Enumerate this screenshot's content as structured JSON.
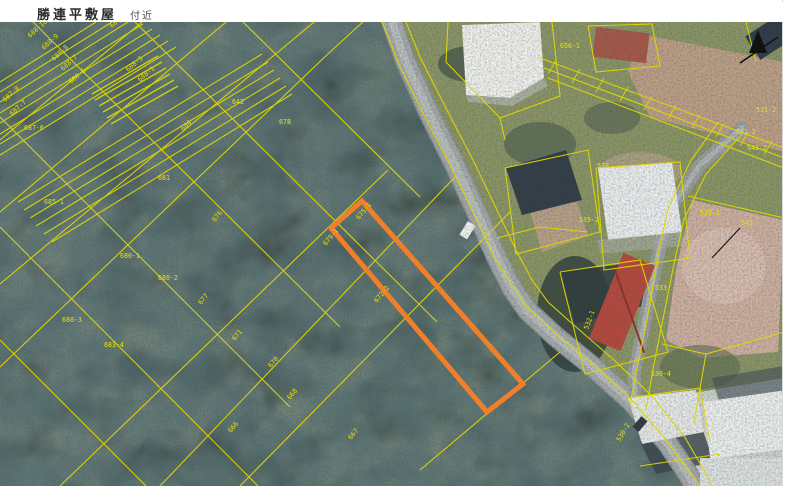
{
  "header": {
    "title": "勝連平敷屋",
    "suffix": "付近"
  },
  "map": {
    "type": "aerial-photo-with-cadastral-overlay",
    "colors": {
      "parcel_line": "#ddd800",
      "parcel_label": "#e9e300",
      "highlight": "#f07f2a",
      "road": "#a6aaa9"
    },
    "highlight_parcel": {
      "label": "675-1"
    },
    "north_arrow": "north-arrow",
    "parcel_labels": [
      {
        "text": "688-10",
        "x": 30,
        "y": 16,
        "r": -42
      },
      {
        "text": "688-9",
        "x": 44,
        "y": 28,
        "r": -42
      },
      {
        "text": "688-8",
        "x": 54,
        "y": 39,
        "r": -42
      },
      {
        "text": "688-7",
        "x": 63,
        "y": 49,
        "r": -42
      },
      {
        "text": "688-6",
        "x": 71,
        "y": 62,
        "r": -40
      },
      {
        "text": "687-8",
        "x": 5,
        "y": 80,
        "r": -42
      },
      {
        "text": "687-7",
        "x": 12,
        "y": 94,
        "r": -42
      },
      {
        "text": "687-6",
        "x": 24,
        "y": 108,
        "r": 0
      },
      {
        "text": "688-3",
        "x": 128,
        "y": 50,
        "r": -40
      },
      {
        "text": "688-1",
        "x": 140,
        "y": 60,
        "r": -40
      },
      {
        "text": "683",
        "x": 112,
        "y": 6,
        "r": -42
      },
      {
        "text": "642",
        "x": 232,
        "y": 82,
        "r": 0
      },
      {
        "text": "678",
        "x": 279,
        "y": 102,
        "r": 0
      },
      {
        "text": "684",
        "x": 183,
        "y": 109,
        "r": -42
      },
      {
        "text": "681",
        "x": 158,
        "y": 158,
        "r": 0
      },
      {
        "text": "676",
        "x": 215,
        "y": 200,
        "r": -50
      },
      {
        "text": "685-1",
        "x": 44,
        "y": 182,
        "r": 0
      },
      {
        "text": "680-1",
        "x": 120,
        "y": 236,
        "r": 0
      },
      {
        "text": "680-2",
        "x": 158,
        "y": 258,
        "r": 0
      },
      {
        "text": "680-3",
        "x": 62,
        "y": 300,
        "r": 0
      },
      {
        "text": "683-4",
        "x": 104,
        "y": 325,
        "r": 0
      },
      {
        "text": "677",
        "x": 201,
        "y": 283,
        "r": -50
      },
      {
        "text": "679-1",
        "x": 326,
        "y": 224,
        "r": -50
      },
      {
        "text": "675-1",
        "x": 359,
        "y": 198,
        "r": -50
      },
      {
        "text": "672-2",
        "x": 377,
        "y": 281,
        "r": -50
      },
      {
        "text": "671",
        "x": 235,
        "y": 319,
        "r": -50
      },
      {
        "text": "670",
        "x": 271,
        "y": 346,
        "r": -50
      },
      {
        "text": "668",
        "x": 290,
        "y": 378,
        "r": -50
      },
      {
        "text": "666",
        "x": 231,
        "y": 411,
        "r": -50
      },
      {
        "text": "667",
        "x": 351,
        "y": 418,
        "r": -50
      },
      {
        "text": "656-1",
        "x": 560,
        "y": 26,
        "r": 0
      },
      {
        "text": "538",
        "x": 597,
        "y": 146,
        "r": 0
      },
      {
        "text": "535-2",
        "x": 579,
        "y": 200,
        "r": 0
      },
      {
        "text": "533-1",
        "x": 700,
        "y": 193,
        "r": 0
      },
      {
        "text": "545",
        "x": 741,
        "y": 203,
        "r": 0
      },
      {
        "text": "542-2",
        "x": 747,
        "y": 128,
        "r": 0
      },
      {
        "text": "531-2",
        "x": 756,
        "y": 90,
        "r": 0
      },
      {
        "text": "532-2",
        "x": 736,
        "y": 112,
        "r": 0
      },
      {
        "text": "533",
        "x": 655,
        "y": 268,
        "r": 0
      },
      {
        "text": "532-1",
        "x": 588,
        "y": 308,
        "r": -70
      },
      {
        "text": "530-4",
        "x": 651,
        "y": 354,
        "r": 0
      },
      {
        "text": "530-2",
        "x": 620,
        "y": 420,
        "r": -60
      }
    ]
  }
}
